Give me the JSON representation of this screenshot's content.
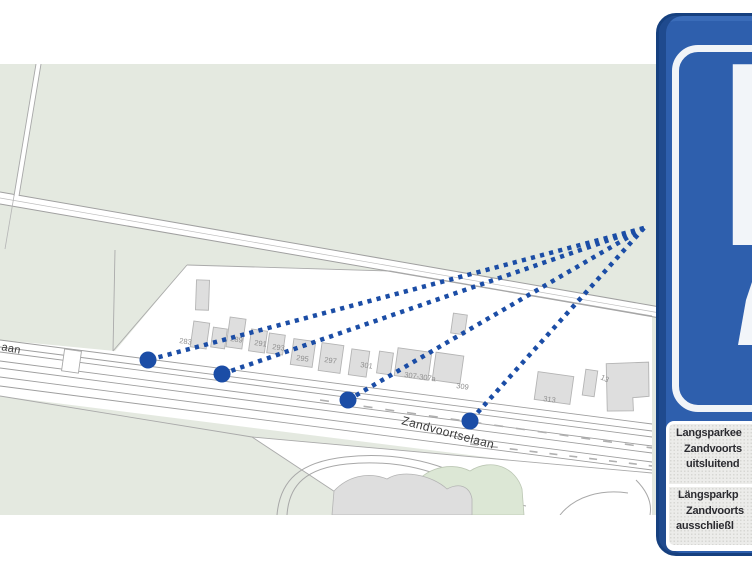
{
  "map": {
    "street_labels": [
      {
        "text": "Zandvoortselaan",
        "x": 401,
        "y": 424,
        "rot": 15,
        "size": 12
      },
      {
        "text": "aan",
        "x": 1,
        "y": 350,
        "rot": 11,
        "size": 11
      }
    ],
    "house_numbers": [
      {
        "label": "283",
        "x": 179,
        "y": 343,
        "rot": 8
      },
      {
        "label": "289",
        "x": 230,
        "y": 341,
        "rot": 8
      },
      {
        "label": "291",
        "x": 254,
        "y": 345,
        "rot": 8
      },
      {
        "label": "293",
        "x": 272,
        "y": 349,
        "rot": 8
      },
      {
        "label": "295",
        "x": 296,
        "y": 360,
        "rot": 8
      },
      {
        "label": "297",
        "x": 324,
        "y": 362,
        "rot": 8
      },
      {
        "label": "301",
        "x": 360,
        "y": 367,
        "rot": 8
      },
      {
        "label": "307-307a",
        "x": 404,
        "y": 377,
        "rot": 8
      },
      {
        "label": "309",
        "x": 456,
        "y": 388,
        "rot": 8
      },
      {
        "label": "313",
        "x": 543,
        "y": 401,
        "rot": 8
      },
      {
        "label": "13",
        "x": 600,
        "y": 379,
        "rot": 25
      }
    ],
    "markers": [
      {
        "x": 148,
        "y": 360
      },
      {
        "x": 222,
        "y": 374
      },
      {
        "x": 348,
        "y": 400
      },
      {
        "x": 470,
        "y": 421
      }
    ],
    "convergence": {
      "x": 644,
      "y": 228
    },
    "colors": {
      "background_green": "#e4e9e0",
      "patch_green": "#dce7d5",
      "building_fill": "#dedede",
      "building_stroke": "#b4b4b4",
      "line_gray": "#a8a8a8",
      "marker_blue": "#1b4da6"
    }
  },
  "sign": {
    "symbol": "P",
    "plate_lines_nl": [
      "Langsparkee",
      "Zandvoorts",
      "uitsluitend"
    ],
    "plate_lines_de": [
      "Längsparkp",
      "Zandvoorts",
      "ausschließl"
    ],
    "colors": {
      "sign_blue": "#2e5fad",
      "frame_border": "#16407f",
      "ring_white": "#f1f4f8",
      "plate_bg": "#ececea",
      "plate_text": "#2b2b30"
    }
  }
}
